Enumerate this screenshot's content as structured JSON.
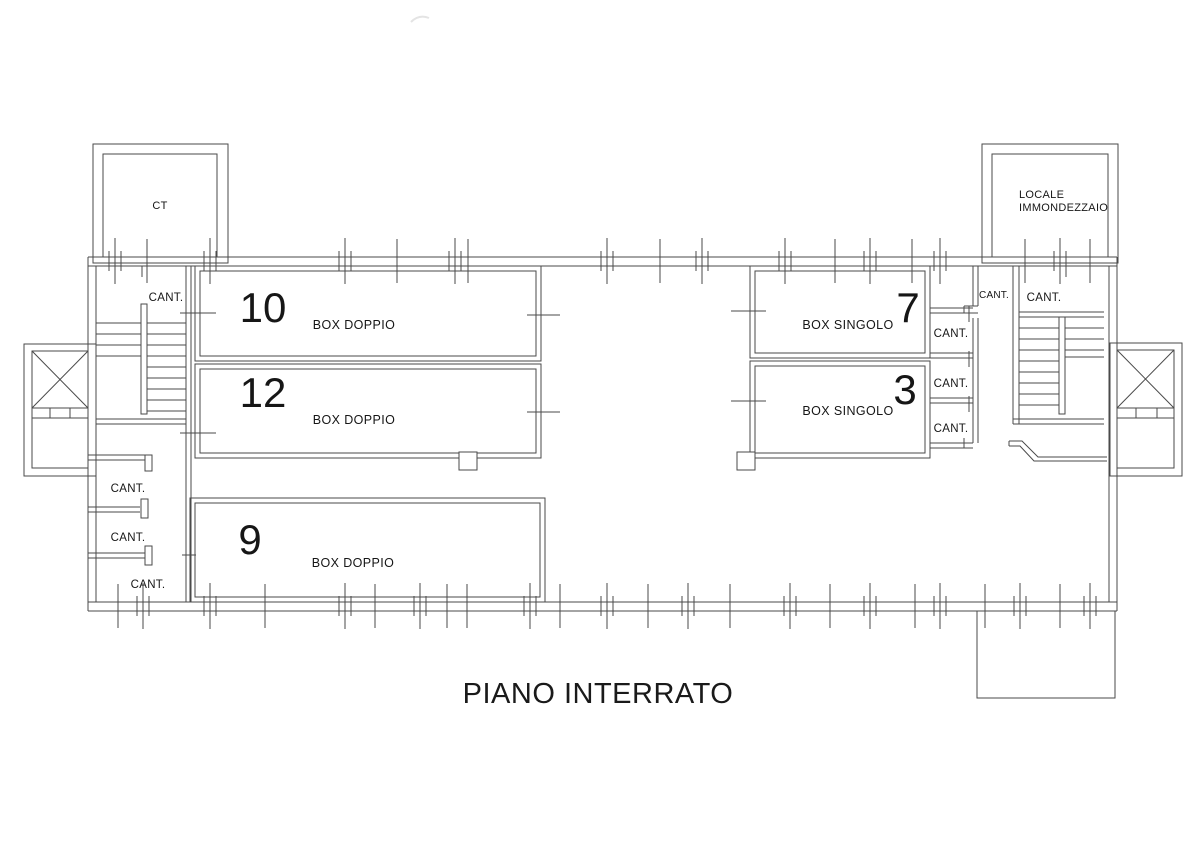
{
  "title": "PIANO INTERRATO",
  "colors": {
    "background": "#ffffff",
    "line": "#4a4a4a",
    "text": "#161616"
  },
  "labels": {
    "cant": "CANT.",
    "ct": "CT",
    "waste_line1": "LOCALE",
    "waste_line2": "IMMONDEZZAIO"
  },
  "boxes": {
    "box10": {
      "number": "10",
      "type": "BOX DOPPIO"
    },
    "box12": {
      "number": "12",
      "type": "BOX DOPPIO"
    },
    "box9": {
      "number": "9",
      "type": "BOX DOPPIO"
    },
    "box7": {
      "number": "7",
      "type": "BOX SINGOLO"
    },
    "box3": {
      "number": "3",
      "type": "BOX SINGOLO"
    }
  }
}
